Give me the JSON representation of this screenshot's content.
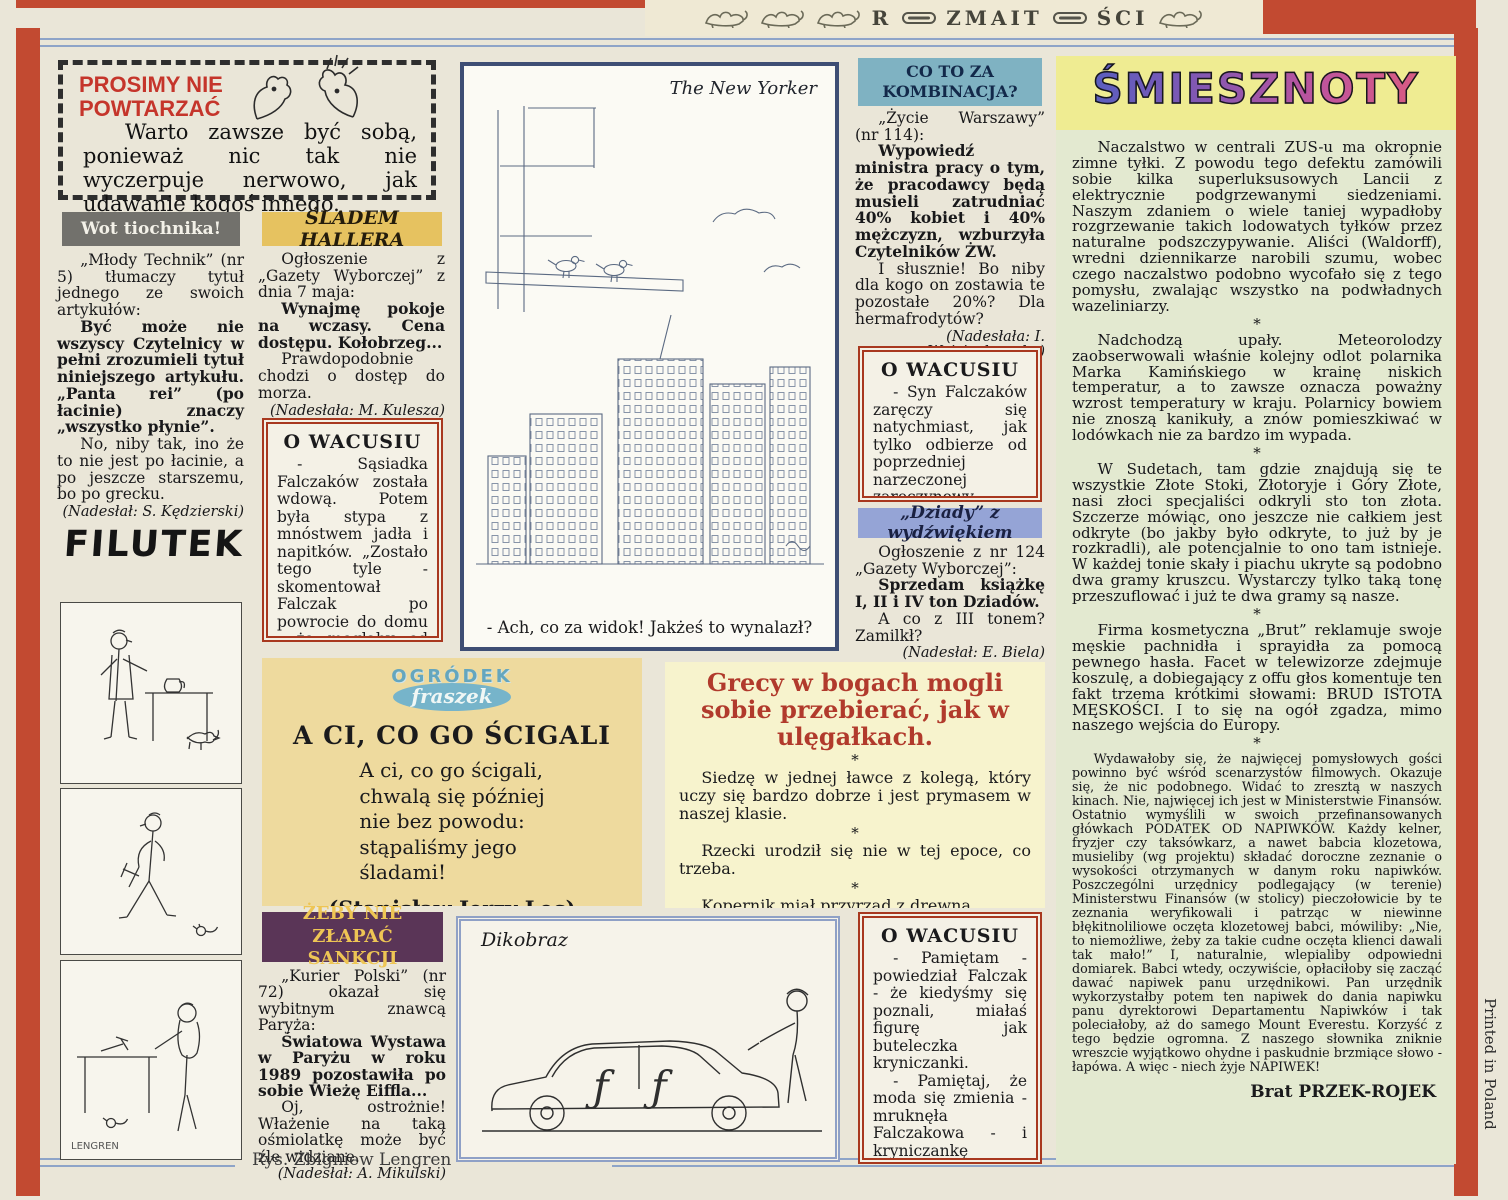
{
  "masthead": {
    "part1": "R",
    "part2": "ZMAIT",
    "part3": "ŚCI"
  },
  "prosimy": {
    "title_line1": "PROSIMY NIE",
    "title_line2": "POWTARZAĆ",
    "text": "Warto zawsze być sobą, ponieważ nic tak nie wyczerpuje nerwowo, jak udawanie kogoś innego."
  },
  "wot": {
    "header": "Wot tiochnika!",
    "intro": "„Młody Technik” (nr 5) tłumaczy tytuł jednego ze swoich artykułów:",
    "quote": "Być może nie wszyscy Czytelnicy w pełni zrozumieli tytuł niniejszego artykułu. „Panta rei” (po łacinie) znaczy „wszystko płynie”.",
    "comment": "No, niby tak, ino że to nie jest po łacinie, a po jeszcze starszemu, bo po grecku.",
    "credit": "(Nadesłał: S. Kędzierski)"
  },
  "sladem": {
    "header": "ŚLADEM HALLERA",
    "intro": "Ogłoszenie z „Gazety Wyborczej” z dnia 7 maja:",
    "quote": "Wynajmę pokoje na wczasy. Cena dostępu. Kołobrzeg...",
    "comment": "Prawdopodobnie chodzi o dostęp do morza.",
    "credit": "(Nadesłała: M. Kulesza)"
  },
  "wacusiu1": {
    "title": "O WACUSIU",
    "text": "- Sąsiadka Falczaków została wdową. Potem była stypa z mnóstwem jadła i napitków. „Zostało tego tyle - skomentował Falczak po powrocie do domu - że mogłaby od razu pomyśleć o weselu”."
  },
  "newyorker": {
    "label": "The New Yorker",
    "caption": "- Ach, co za widok! Jakżeś to wynalazł?"
  },
  "cotoza": {
    "header_line1": "CO TO ZA",
    "header_line2": "KOMBINACJA?",
    "intro": "„Życie Warszawy” (nr 114):",
    "quote": "Wypowiedź ministra pracy o tym, że pracodawcy będą musieli zatrudniać 40% kobiet i 40% mężczyzn, wzburzyła Czytelników ŻW.",
    "comment": "I słusznie! Bo niby dla kogo on zostawia te pozostałe 20%? Dla hermafrodytów?",
    "credit": "(Nadesłała: I. Wojciechowska)"
  },
  "wacusiu2": {
    "title": "O WACUSIU",
    "text": "- Syn Falczaków zaręczy się natychmiast, jak tylko odbierze od poprzedniej narzeczonej zaręczynowy pierścionek."
  },
  "dziady": {
    "header": "„Dziady” z wydźwiękiem",
    "intro": "Ogłoszenie z nr 124 „Gazety Wyborczej”:",
    "quote": "Sprzedam książkę I, II i IV ton Dziadów.",
    "comment": "A co z III tonem? Zamilkł?",
    "credit": "(Nadesłał: E. Biela)"
  },
  "ogrodek": {
    "logo_line1": "OGRÓDEK",
    "logo_line2": "fraszek",
    "title": "A CI, CO GO ŚCIGALI",
    "poem": "A ci, co go ścigali,\nchwalą się później\nnie bez powodu:\nstąpaliśmy jego\nśladami!",
    "author": "(Stanisław Jerzy Lec)"
  },
  "grecy": {
    "heading": "Grecy w bogach mogli sobie przebierać, jak w ulęgałkach.",
    "separator": "*",
    "items": [
      "Siedzę w jednej ławce z kolegą, który uczy się bardzo dobrze i jest prymasem w naszej klasie.",
      "Rzecki urodził się nie w tej epoce, co trzeba.",
      "Kopernik miał przyrząd z drewna."
    ],
    "footer": "HUMOR ZESZYTÓW nadesłali: A. Kozarzewski z Pułtuska, J. Kaptur z Tomaszowa Lubelskiego, J. Bilska z Radzynia i W. Czermak-Nowina z Lidzbarku Warmińskiego. Dziękujemy."
  },
  "zeby": {
    "header_line1": "ŻEBY NIE ZŁAPAĆ",
    "header_line2": "SANKCJI",
    "intro": "„Kurier Polski” (nr 72) okazał się wybitnym znawcą Paryża:",
    "quote": "Światowa Wystawa w Paryżu w roku 1989 pozostawiła po sobie Wieżę Eiffla...",
    "comment": "Oj, ostrożnie! Włażenie na taką ośmiolatkę może być źle widziane.",
    "credit": "(Nadesłał: A. Mikulski)"
  },
  "dikobraz": {
    "label": "Dikobraz"
  },
  "wacusiu3": {
    "title": "O WACUSIU",
    "para1": "- Pamiętam - powiedział Falczak - że kiedyśmy się poznali, miałaś figurę jak buteleczka kryniczanki.",
    "para2": "- Pamiętaj, że moda się zmienia - mruknęła Falczakowa - i kryniczankę sprzedają teraz w butelkach półtoralitrowych."
  },
  "smiesznoty": {
    "title": "ŚMIESZNOTY",
    "separator": "*",
    "items": [
      "Naczalstwo w centrali ZUS-u ma okropnie zimne tyłki. Z powodu tego defektu zamówili sobie kilka superluksusowych Lancii z elektrycznie podgrzewanymi siedzeniami. Naszym zdaniem o wiele taniej wypadłoby rozgrzewanie takich lodowatych tyłków przez naturalne podszczypywanie. Aliści (Waldorff), wredni dziennikarze narobili szumu, wobec czego naczalstwo podobno wycofało się z tego pomysłu, zwalając wszystko na podwładnych wazeliniarzy.",
      "Nadchodzą upały. Meteorolodzy zaobserwowali właśnie kolejny odlot polarnika Marka Kamińskiego w krainę niskich temperatur, a to zawsze oznacza poważny wzrost temperatury w kraju. Polarnicy bowiem nie znoszą kanikuły, a znów pomieszkiwać w lodówkach nie za bardzo im wypada.",
      "W Sudetach, tam gdzie znajdują się te wszystkie Złote Stoki, Złotoryje i Góry Złote, nasi złoci specjaliści odkryli sto ton złota. Szczerze mówiąc, ono jeszcze nie całkiem jest odkryte (bo jakby było odkryte, to już by je rozkradli), ale potencjalnie to ono tam istnieje. W każdej tonie skały i piachu ukryte są podobno dwa gramy kruszcu. Wystarczy tylko taką tonę przeszuflować i już te dwa gramy są nasze.",
      "Firma kosmetyczna „Brut” reklamuje swoje męskie pachnidła i sprayidła za pomocą pewnego hasła. Facet w telewizorze zdejmuje koszulę, a dobiegający z offu głos komentuje ten fakt trzema krótkimi słowami: BRUD ISTOTA MĘSKOŚCI. I to się na ogół zgadza, mimo naszego wejścia do Europy.",
      "Wydawałoby się, że najwięcej pomysłowych gości powinno być wśród scenarzystów filmowych. Okazuje się, że nic podobnego. Widać to zresztą w naszych kinach. Nie, najwięcej ich jest w Ministerstwie Finansów. Ostatnio wymyślili w swoich przefinansowanych główkach PODATEK OD NAPIWKÓW. Każdy kelner, fryzjer czy taksówkarz, a nawet babcia klozetowa, musieliby (wg projektu) składać doroczne zeznanie o wysokości otrzymanych w danym roku napiwków. Poszczególni urzędnicy podlegający (w terenie) Ministerstwu Finansów (w stolicy) pieczołowicie by te zeznania weryfikowali i patrząc w niewinne błękitnoliliowe oczęta klozetowej babci, mówiliby: „Nie, to niemożliwe, żeby za takie cudne oczęta klienci dawali tak mało!” I, naturalnie, wlepialiby odpowiedni domiarek. Babci wtedy, oczywiście, opłaciłoby się zacząć dawać napiwek panu urzędnikowi. Pan urzędnik wykorzystałby potem ten napiwek do dania napiwku panu dyrektorowi Departamentu Napiwków i tak poleciałoby, aż do samego Mount Everestu. Korzyść z tego będzie ogromna. Z naszego słownika zniknie wreszcie wyjątkowo ohydne i paskudnie brzmiące słowo - łapówa. A więc - niech żyje NAPIWEK!"
    ],
    "signature": "Brat PRZEK-ROJEK"
  },
  "filutek": {
    "logo": "FILUTEK",
    "signature": "LENGREN"
  },
  "footer": {
    "credit": "Rys. Zbigniew Lengren"
  },
  "margin_note": "Printed in Poland",
  "colors": {
    "frame_red": "#c24a31",
    "header_gray": "#72716c",
    "header_tan": "#e6c260",
    "header_blue": "#7fb2c2",
    "header_periwinkle": "#95a4d6",
    "header_purple": "#5a3557",
    "box_red_border": "#a8381f",
    "smiesznoty_yellow": "#efec92",
    "smiesznoty_green": "#e3e9d0",
    "grecy_bg": "#f7f3cd",
    "ogrodek_bg": "#eeda9e",
    "heading_red": "#b13a2c",
    "rule_blue": "#8ea4c8"
  }
}
